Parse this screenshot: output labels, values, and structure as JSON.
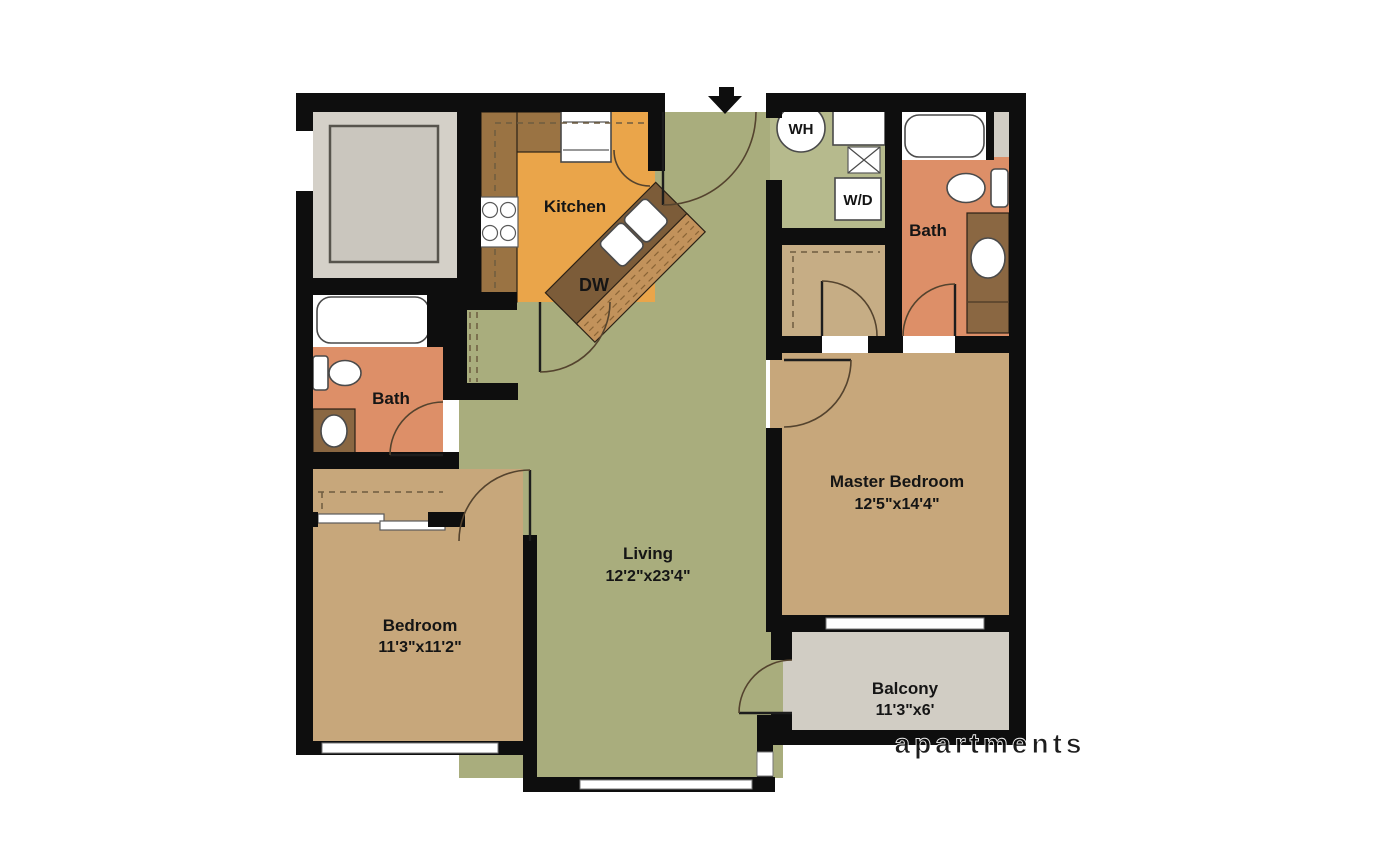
{
  "plan": {
    "rooms": {
      "kitchen": {
        "label": "Kitchen"
      },
      "living": {
        "label": "Living",
        "dims": "12'2\"x23'4\""
      },
      "master_bedroom": {
        "label": "Master Bedroom",
        "dims": "12'5\"x14'4\""
      },
      "bedroom": {
        "label": "Bedroom",
        "dims": "11'3\"x11'2\""
      },
      "bath_left": {
        "label": "Bath"
      },
      "bath_right": {
        "label": "Bath"
      },
      "balcony": {
        "label": "Balcony",
        "dims": "11'3\"x6'"
      }
    },
    "fixture_labels": {
      "water_heater": "WH",
      "washer_dryer": "W/D",
      "dishwasher": "DW"
    },
    "watermark": "apartments",
    "colors": {
      "wall": "#0e0e0e",
      "living_green": "#a9ad7d",
      "laundry_green": "#b6ba8d",
      "kitchen_orange": "#eaa54a",
      "counter_brown": "#9a7343",
      "island_dark": "#7c5c39",
      "island_wood": "#c2925b",
      "bath_salmon": "#dd8f68",
      "vanity_brown": "#8a6742",
      "bedroom_tan": "#c7a77b",
      "closet_tan": "#c6ad85",
      "balcony_gray": "#d1cdc4",
      "room_gray": "#d4d0c8",
      "inner_gray": "#cac6be",
      "white": "#ffffff"
    }
  }
}
